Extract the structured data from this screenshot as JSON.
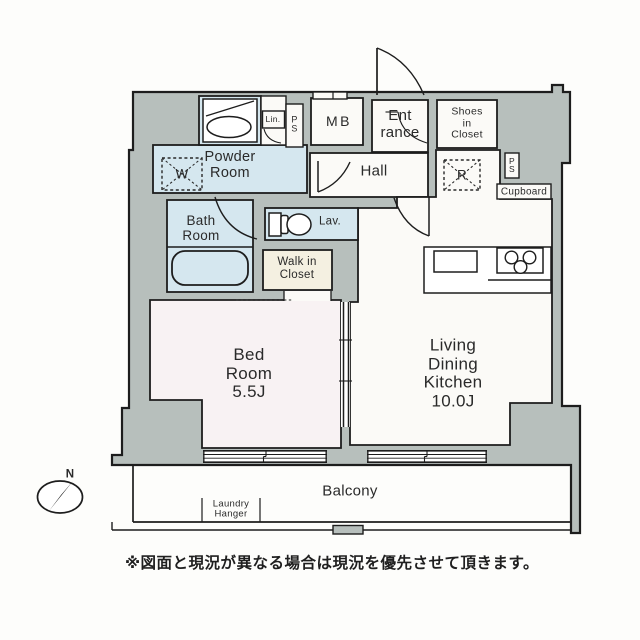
{
  "colors": {
    "wall": "#b7bfbc",
    "wet_room": "#d5e7ef",
    "floor": "#fbfaf7",
    "bedroom_floor": "#f8f2f3",
    "closet_floor": "#f4f0e1",
    "line": "#1d1d1d"
  },
  "rooms": {
    "powder_room": {
      "label": "Powder\nRoom"
    },
    "hall": {
      "label": "Hall"
    },
    "entrance": {
      "label": "Ent\nrance"
    },
    "meter_box": {
      "label": "MB"
    },
    "shoes_in_closet": {
      "label": "Shoes\nin\nCloset"
    },
    "pipe_space_top": {
      "label": "P\nS"
    },
    "linen_closet": {
      "label": "Lin."
    },
    "pipe_space_right": {
      "label": "P\nS"
    },
    "cupboard": {
      "label": "Cupboard"
    },
    "refrigerator_space": {
      "label": "R"
    },
    "washer_space": {
      "label": "W"
    },
    "lavatory": {
      "label": "Lav."
    },
    "bath_room": {
      "label": "Bath\nRoom"
    },
    "walk_in_closet": {
      "label": "Walk in\nCloset"
    },
    "bed_room": {
      "label": "Bed\nRoom\n5.5J"
    },
    "living_dining_kitchen": {
      "label": "Living\nDining\nKitchen\n10.0J"
    },
    "balcony": {
      "label": "Balcony"
    },
    "laundry_hanger": {
      "label": "Laundry\nHanger"
    }
  },
  "compass": {
    "north_label": "N"
  },
  "footer": {
    "disclaimer": "※図面と現況が異なる場合は現況を優先させて頂きます。"
  }
}
